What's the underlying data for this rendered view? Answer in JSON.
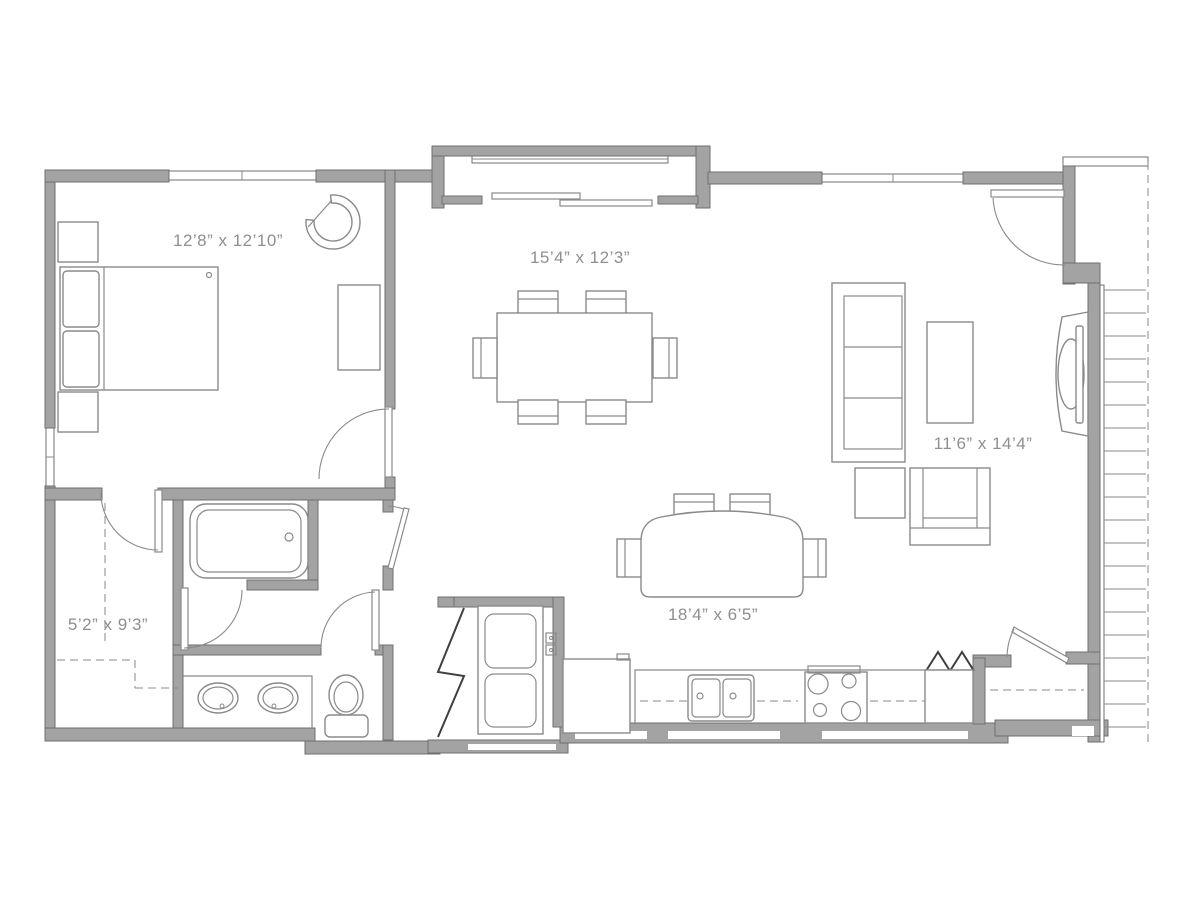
{
  "floor_plan": {
    "colors": {
      "wall": "#a3a3a3",
      "wall_edge": "#6f6f6f",
      "line": "#8a8a8a",
      "dark": "#3f3f3f",
      "text": "#8f8f8f",
      "bg": "#ffffff"
    },
    "labels": {
      "bedroom": "12’8” x 12’10”",
      "dining": "15’4” x 12’3”",
      "living": "11’6” x 14’4”",
      "walk_in_closet": "5’2” x 9’3”",
      "kitchen": "18’4” x 6’5”"
    }
  }
}
